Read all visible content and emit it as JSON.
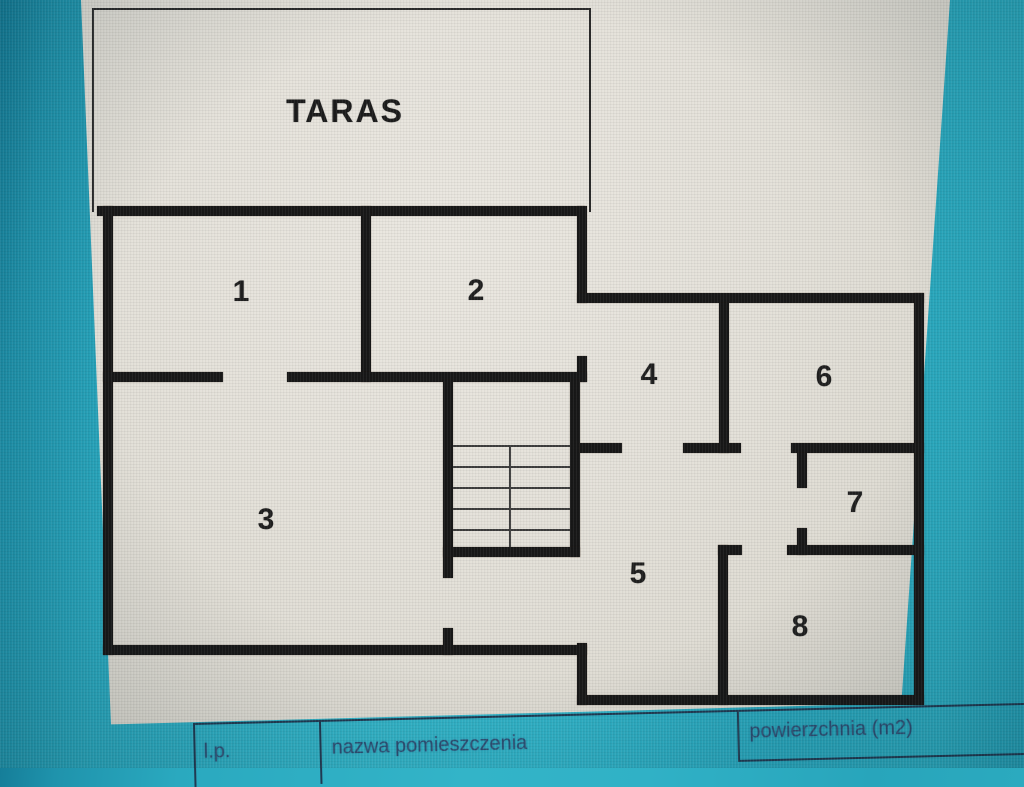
{
  "plan": {
    "terrace_label": "TARAS",
    "room_labels": [
      "1",
      "2",
      "3",
      "4",
      "5",
      "6",
      "7",
      "8"
    ]
  },
  "table": {
    "headers": [
      {
        "label": "l.p."
      },
      {
        "label": "nazwa pomieszczenia"
      },
      {
        "label": "powierzchnia (m2)"
      }
    ]
  },
  "colors": {
    "screen_teal": "#2badc2",
    "page_beige": "#e4e1d9",
    "wall_black": "#181818",
    "table_text_blue": "#2e4f74"
  }
}
